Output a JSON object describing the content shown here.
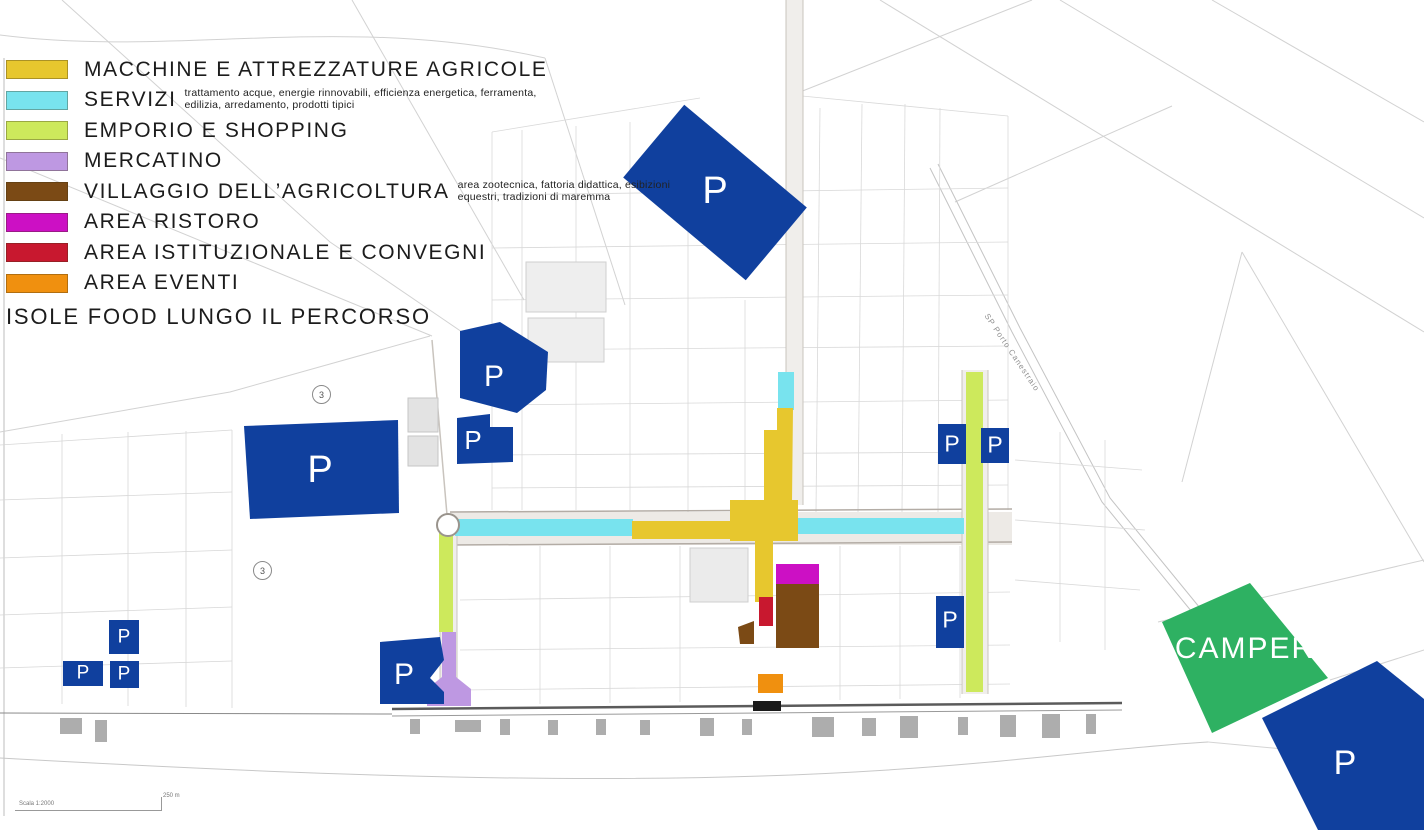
{
  "legend": {
    "items": [
      {
        "label": "MACCHINE E ATTREZZATURE AGRICOLE",
        "note": ""
      },
      {
        "label": "SERVIZI",
        "note": "trattamento acque, energie rinnovabili, efficienza energetica, ferramenta, edilizia, arredamento, prodotti tipici"
      },
      {
        "label": "EMPORIO E SHOPPING",
        "note": ""
      },
      {
        "label": "MERCATINO",
        "note": ""
      },
      {
        "label": "VILLAGGIO DELL’AGRICOLTURA",
        "note": "area zootecnica, fattoria didattica, esibizioni equestri, tradizioni di maremma"
      },
      {
        "label": "AREA RISTORO",
        "note": ""
      },
      {
        "label": "AREA ISTITUZIONALE E CONVEGNI",
        "note": ""
      },
      {
        "label": "AREA EVENTI",
        "note": ""
      }
    ],
    "footer": "ISOLE FOOD LUNGO IL PERCORSO"
  },
  "colors": {
    "macchine": "#E7C72E",
    "servizi": "#78E3EE",
    "emporio": "#CDE95C",
    "mercatino": "#BE98E2",
    "villaggio": "#7B4A15",
    "ristoro": "#CC10C4",
    "istituzionale": "#C8182F",
    "eventi": "#F0900F",
    "parking": "#10409E",
    "camper": "#2EB162"
  },
  "map": {
    "parking_label": "P",
    "camper_label": "CAMPER",
    "road_sign": "3",
    "road_name": "SP Porto Canestraio",
    "scale_text": "Scala 1:2000",
    "scale_distance": "250 m"
  }
}
